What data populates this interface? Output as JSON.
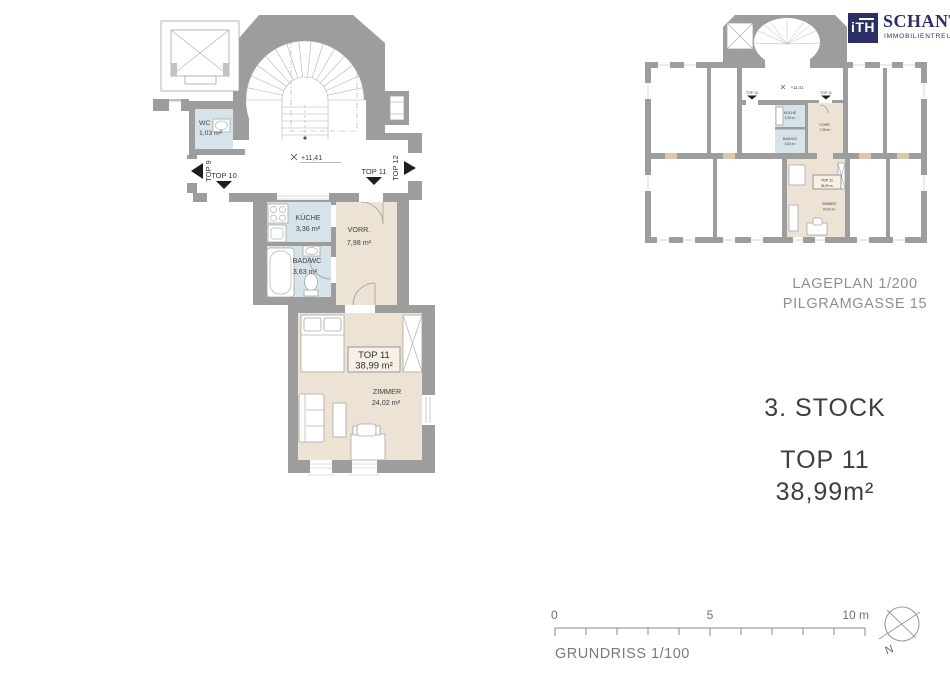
{
  "logo": {
    "mark": "iTH",
    "name": "SCHANTL",
    "tagline": "IMMOBILIENTREUHAND"
  },
  "floor_plan": {
    "level_marker": "+11,41",
    "units": {
      "top9": "TOP 9",
      "top10": "TOP 10",
      "top11": "TOP 11",
      "top12": "TOP 12"
    },
    "rooms": {
      "wc": {
        "name": "WC",
        "area": "1,03 m²"
      },
      "kueche": {
        "name": "KÜCHE",
        "area": "3,36 m²"
      },
      "bad": {
        "name": "BAD/WC",
        "area": "3,63 m²"
      },
      "vorr": {
        "name": "VORR.",
        "area": "7,98 m²"
      },
      "zimmer": {
        "name": "ZIMMER",
        "area": "24,02 m²"
      }
    },
    "unit_box": {
      "name": "TOP 11",
      "area": "38,99 m²"
    }
  },
  "site_plan": {
    "caption": {
      "line1": "LAGEPLAN 1/200",
      "line2": "PILGRAMGASSE 15"
    },
    "level_marker": "+11,41",
    "units": {
      "top10": "TOP 10",
      "top11": "TOP 11"
    },
    "rooms": {
      "kueche": {
        "name": "KÜCHE",
        "area": "3,36 m²"
      },
      "bad": {
        "name": "BAD/WC",
        "area": "3,63 m²"
      },
      "vorr": {
        "name": "VORR.",
        "area": "7,98 m²"
      },
      "zimmer": {
        "name": "ZIMMER",
        "area": "24,02 m²"
      }
    },
    "unit_box": {
      "name": "TOP 11",
      "area": "38,99 m²"
    }
  },
  "info": {
    "floor": "3. STOCK",
    "unit": "TOP 11",
    "area": "38,99m²"
  },
  "scale_bar": {
    "tick0": "0",
    "tick5": "5",
    "tick10": "10 m",
    "caption": "GRUNDRISS 1/100"
  },
  "compass": {
    "north": "N"
  },
  "colors": {
    "wall": "#9d9d9d",
    "wet_room": "#d6e4e9",
    "warm_room": "#ece3d5",
    "navy": "#2c2f63"
  }
}
